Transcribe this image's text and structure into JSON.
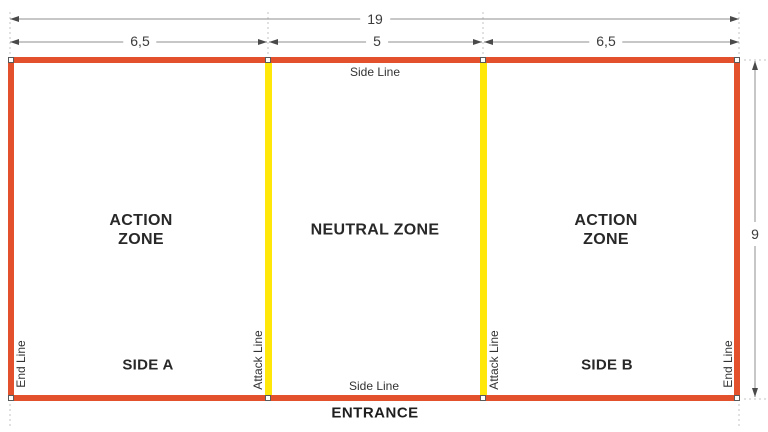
{
  "dimensions": {
    "total_width": "19",
    "left_zone_width": "6,5",
    "neutral_zone_width": "5",
    "right_zone_width": "6,5",
    "court_height": "9"
  },
  "labels": {
    "side_line_top": "Side Line",
    "side_line_bottom": "Side Line",
    "end_line_left": "End Line",
    "end_line_right": "End Line",
    "attack_line_left": "Attack Line",
    "attack_line_right": "Attack Line",
    "action_zone_left_line1": "ACTION",
    "action_zone_left_line2": "ZONE",
    "neutral_zone": "NEUTRAL ZONE",
    "action_zone_right_line1": "ACTION",
    "action_zone_right_line2": "ZONE",
    "side_a": "SIDE A",
    "side_b": "SIDE B",
    "entrance": "ENTRANCE"
  },
  "colors": {
    "boundary_line": "#e2512b",
    "attack_line": "#ffe70a",
    "dimension_line": "#8f8f8f",
    "extension_line": "#c3c3c3",
    "text": "#282828"
  }
}
